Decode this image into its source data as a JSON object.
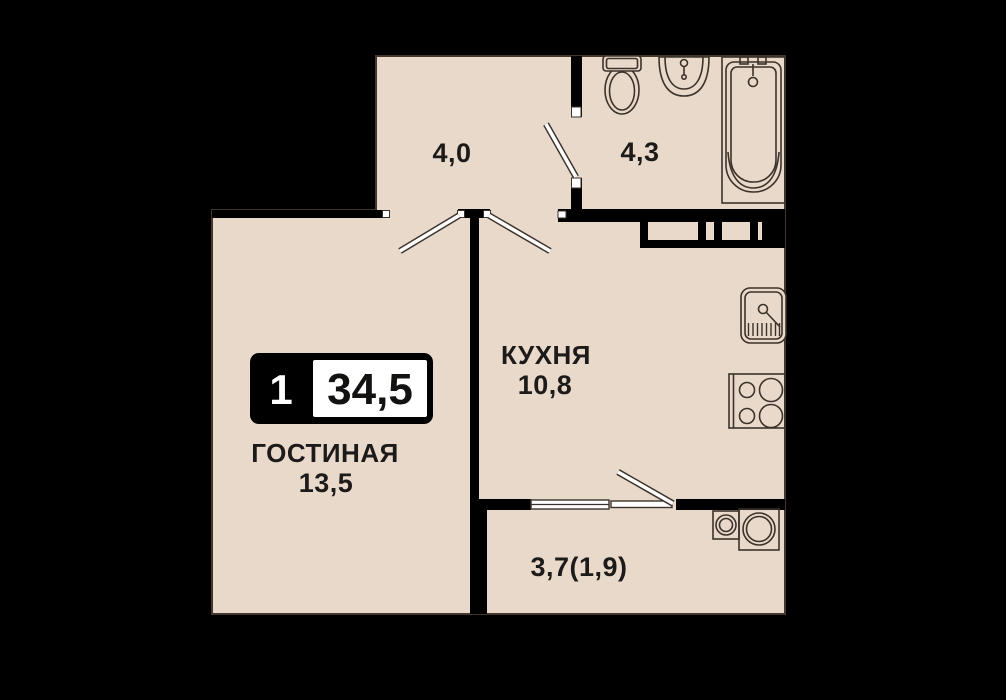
{
  "title": "1-room apartment floor plan",
  "badge": {
    "rooms_count": "1",
    "total_area": "34,5"
  },
  "rooms": {
    "hallway": {
      "area": "4,0"
    },
    "bathroom": {
      "area": "4,3"
    },
    "living": {
      "name": "ГОСТИНАЯ",
      "area": "13,5"
    },
    "kitchen": {
      "name": "КУХНЯ",
      "area": "10,8"
    },
    "balcony": {
      "area": "3,7(1,9)"
    }
  },
  "fixtures": {
    "bathroom": [
      "toilet",
      "wash-basin",
      "bathtub"
    ],
    "kitchen": [
      "kitchen-sink",
      "stove-4-burners"
    ],
    "balcony": [
      "washing-machine",
      "appliance-drum"
    ]
  },
  "colors": {
    "background": "#000000",
    "floor": "#e9d9cb",
    "wall": "#000000",
    "outline": "#44382e",
    "text": "#1d1b19",
    "badge_black": "#000000",
    "badge_white": "#ffffff"
  }
}
